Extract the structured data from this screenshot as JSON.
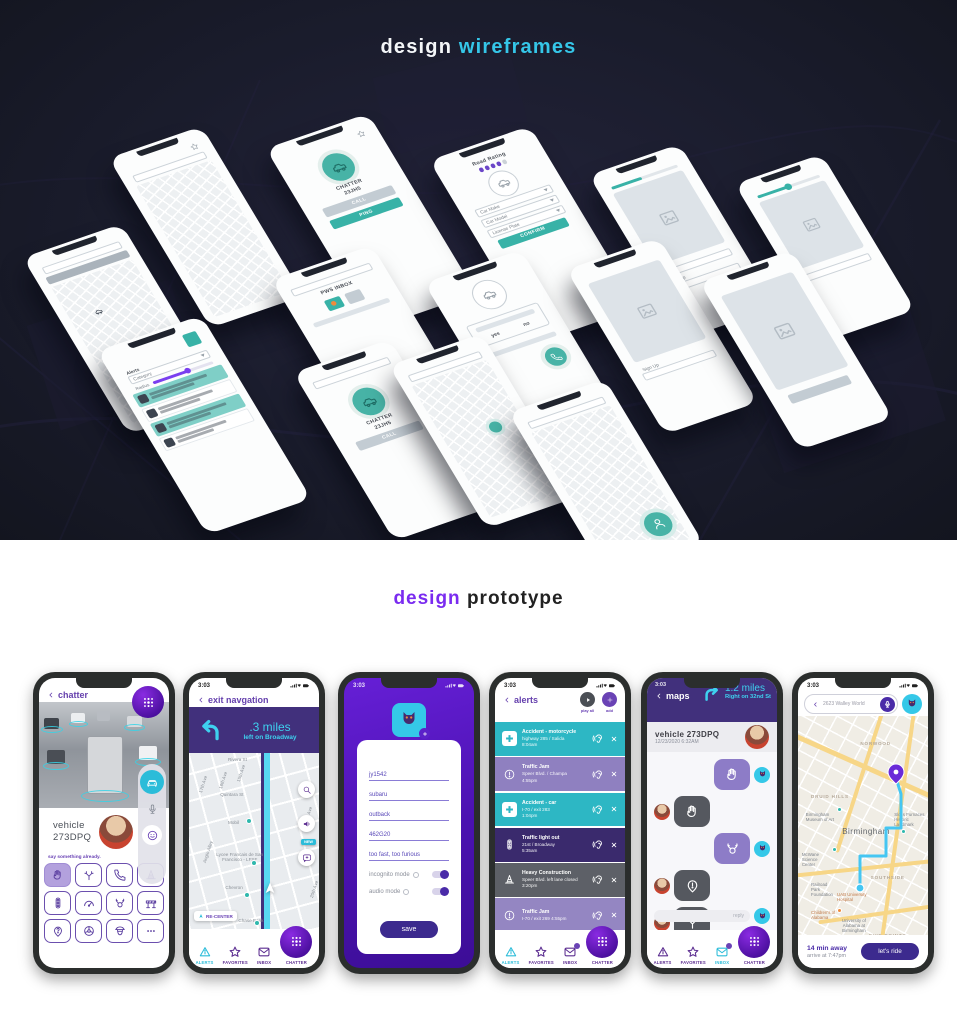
{
  "hero": {
    "title_white": "design",
    "title_cyan": "wireframes"
  },
  "proto_title": {
    "purple": "design",
    "black": "prototype"
  },
  "nav": {
    "alerts": "ALERTS",
    "favorites": "FAVORITES",
    "inbox": "INBOX",
    "chatter": "CHATTER"
  },
  "status": {
    "time": "3:03"
  },
  "wireframes": {
    "call": {
      "line1": "CHATTER",
      "line2": "23JH5",
      "call": "CALL",
      "ping": "PING"
    },
    "rating": {
      "title": "Road Rating",
      "make": "Car Make",
      "model": "Car Model",
      "plate": "License Plate",
      "confirm": "CONFIRM"
    },
    "inbox": {
      "title": "PWS INBOX",
      "voice": "VOICE COMMAND",
      "library": "ICON LIBRARY"
    },
    "signup": {
      "field": "Sign Up"
    },
    "yesno": {
      "yes": "yes",
      "no": "no"
    },
    "alerts": {
      "title": "Alerts",
      "category": "Category",
      "radius": "Radius"
    }
  },
  "p1": {
    "header": "chatter",
    "vehicle1": "vehicle",
    "vehicle2": "273DPQ",
    "hint": "say something already."
  },
  "p2": {
    "header": "exit navgation",
    "distance": ".3 miles",
    "instruction": "left on Broadway",
    "recenter": "RE-CENTER",
    "new_badge": "NEW",
    "labels": {
      "rivera": "Rivera St",
      "quintara": "Quintara St",
      "a17": "17th Ave",
      "a16": "16th Ave",
      "a15": "15th Ave",
      "a30": "30th Ave",
      "a20": "20th Ave",
      "alley": "Anglo Alley",
      "mobil": "Mobil",
      "lycee": "Lycee Francais de San Francisco - LFSF",
      "chevron": "Chevron",
      "chase": "Chase Bank"
    }
  },
  "p3": {
    "f1": "jy1542",
    "f2": "subaru",
    "f3": "outback",
    "f4": "462G20",
    "f5": "too fast, too furious",
    "incognito": "incognito mode",
    "audio": "audio mode",
    "save": "save"
  },
  "p4": {
    "header": "alerts",
    "play_all": "play all",
    "add": "add",
    "rows": [
      {
        "title": "Accident - motorcycle",
        "loc": "highway 285 / Salida",
        "time": "8:04am"
      },
      {
        "title": "Traffic Jam",
        "loc": "Speer Blvd. / Champa",
        "time": "4:55pm"
      },
      {
        "title": "Accident - car",
        "loc": "I-70 / exit 283",
        "time": "1:04pm"
      },
      {
        "title": "Traffic light out",
        "loc": "21st / Broadway",
        "time": "5:35am"
      },
      {
        "title": "Heavy Construction",
        "loc": "Speer Blvd. left lane closed",
        "time": "3:20pm"
      },
      {
        "title": "Traffic Jam",
        "loc": "I-70 / exit 269  4:55pm",
        "time": ""
      }
    ]
  },
  "p5": {
    "header": "maps",
    "distance": "1.2 miles",
    "instruction": "Right on 32nd St",
    "vehicle": "vehicle 273DPQ",
    "timestamp": "12/23/2020  6:32AM",
    "reply": "reply"
  },
  "p6": {
    "search": "2623 Walley World",
    "eta1": "14 min away",
    "eta2": "arrive at 7:47pm",
    "ride": "let's ride",
    "labels": {
      "norwood": "NORWOOD",
      "druid": "DRUID HILLS",
      "city": "Birmingham",
      "southside": "SOUTHSIDE",
      "fivepoints": "FIVE POINTS SOUTH",
      "museum": "Birmingham Museum of Art",
      "sloss": "Sloss Furnaces Historic Landmark",
      "mcwane": "McWane Science Center",
      "railroad": "Railroad Park Foundation",
      "uab": "UAB University Hospital",
      "childrens": "Children's of Alabama",
      "university": "University of Alabama at Birmingham"
    }
  }
}
